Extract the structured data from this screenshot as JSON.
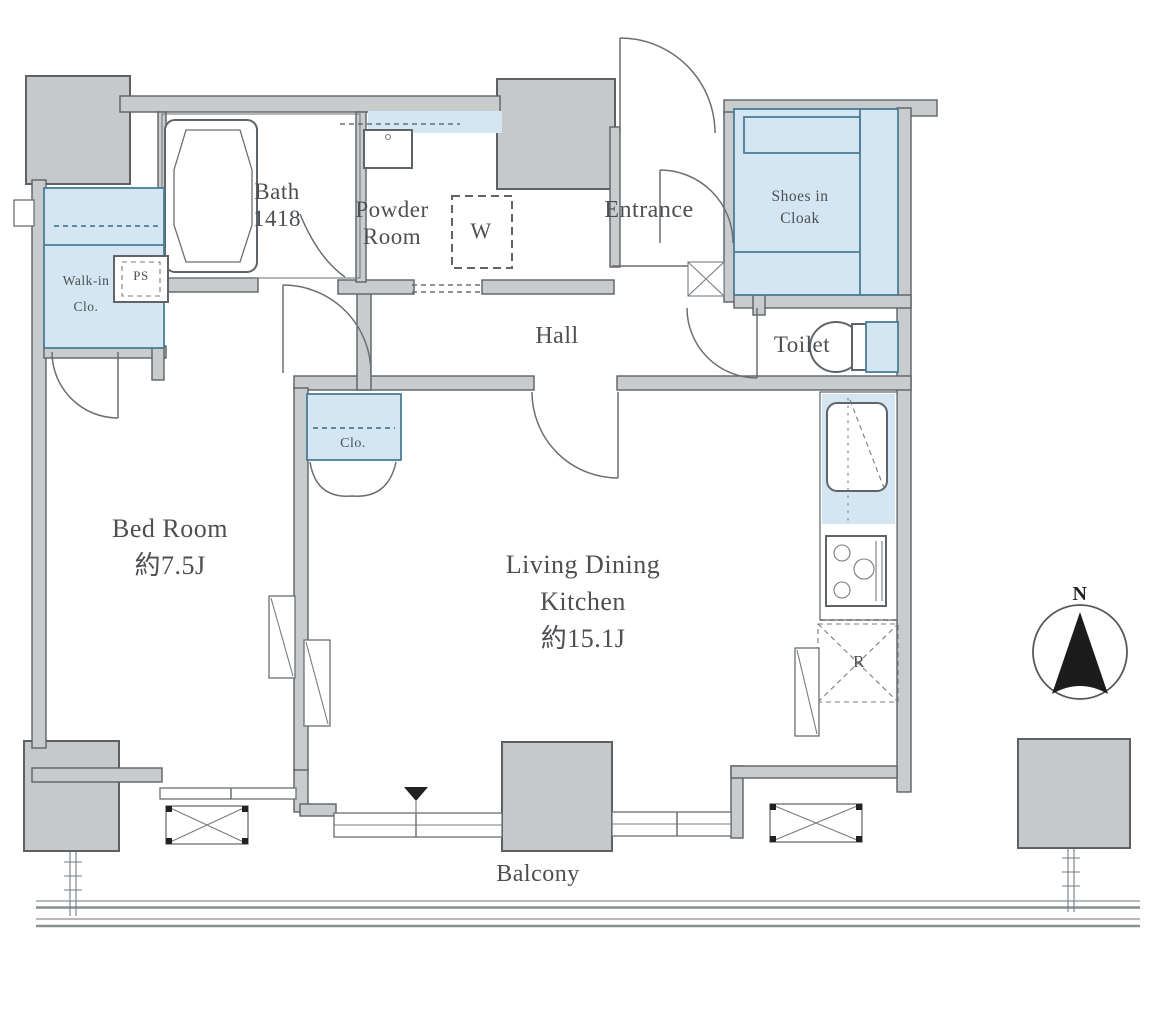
{
  "title": "Apartment floor plan",
  "colors": {
    "wall-fill": "#c9cccd",
    "wall-line": "#5d6164",
    "column-fill": "#c6c8ca",
    "storage-fill": "#d3e6f1",
    "storage-line": "#4a7d96",
    "text": "#4d4f52",
    "needle": "#1c1c1c",
    "railing": "#8a8f92"
  },
  "rooms": {
    "bath": {
      "name": "Bath",
      "size": "1418"
    },
    "powder_room": {
      "line1": "Powder",
      "line2": "Room"
    },
    "washer": {
      "label": "W"
    },
    "entrance": {
      "name": "Entrance"
    },
    "shoes_in_cloak": {
      "line1": "Shoes in",
      "line2": "Cloak"
    },
    "hall": {
      "name": "Hall"
    },
    "toilet": {
      "name": "Toilet"
    },
    "walk_in_closet": {
      "line1": "Walk-in",
      "line2": "Clo."
    },
    "pipe_space": {
      "label": "PS"
    },
    "bedroom": {
      "name": "Bed Room",
      "area": "約7.5J"
    },
    "closet": {
      "label": "Clo."
    },
    "ldk": {
      "line1": "Living Dining",
      "line2": "Kitchen",
      "area": "約15.1J"
    },
    "refrigerator": {
      "label": "R"
    },
    "balcony": {
      "name": "Balcony"
    }
  },
  "compass": {
    "label": "N"
  }
}
